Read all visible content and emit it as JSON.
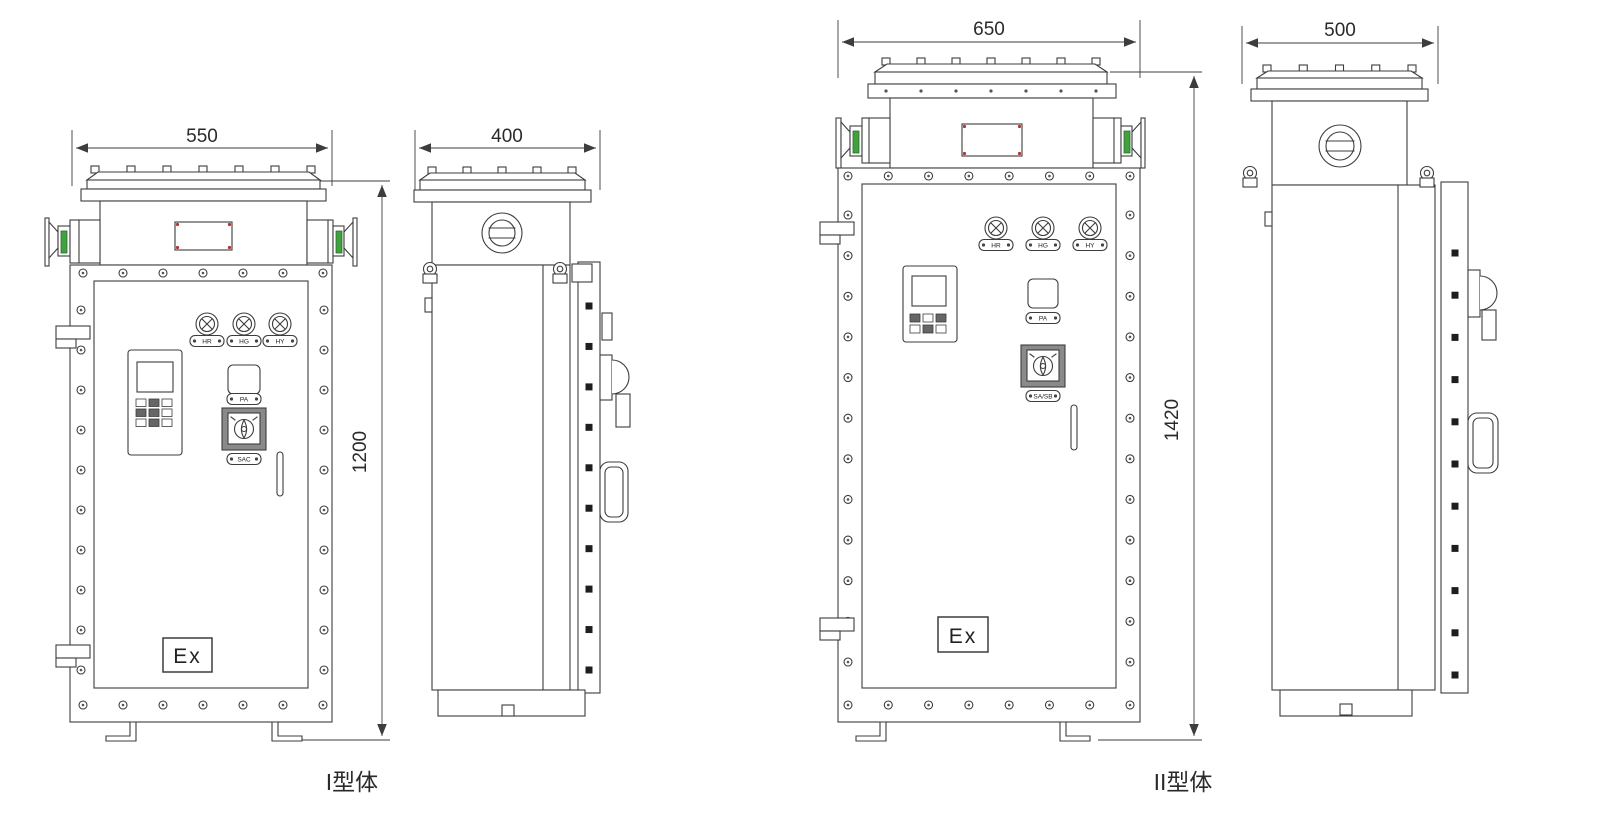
{
  "figures": [
    {
      "caption": "I型体",
      "front": {
        "width": "550",
        "height": "1200",
        "lights": [
          "HR",
          "HG",
          "HY"
        ],
        "button": "PA",
        "switch": "SAC",
        "ex": "Ex"
      },
      "side": {
        "depth": "400"
      }
    },
    {
      "caption": "II型体",
      "front": {
        "width": "650",
        "height": "1420",
        "lights": [
          "HR",
          "HG",
          "HY"
        ],
        "button": "PA",
        "switch": "SA/SB",
        "ex": "Ex"
      },
      "side": {
        "depth": "500"
      }
    }
  ],
  "colors": {
    "line": "#3d3d3d",
    "green": "#3fa23f",
    "red": "#b03535"
  }
}
